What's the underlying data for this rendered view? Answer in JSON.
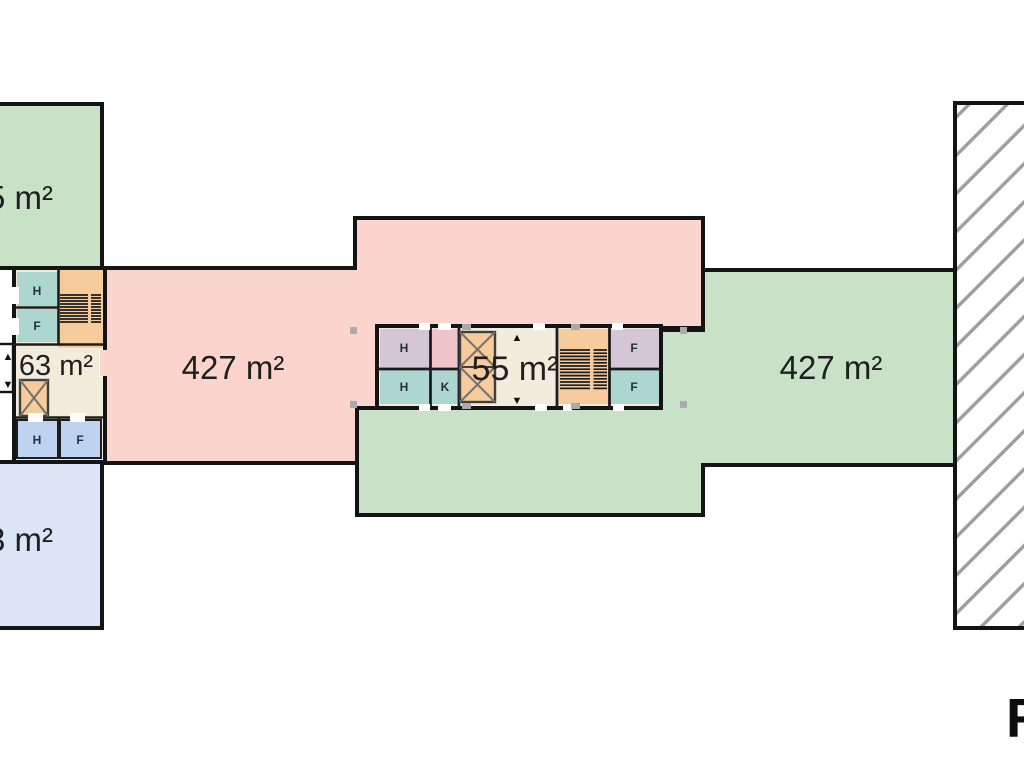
{
  "colors": {
    "wall": "#141414",
    "green_area": "#c9e2c7",
    "pink_area": "#fbd4cd",
    "blue_area": "#dbe5f6",
    "blue_room": "#bfd2ef",
    "teal_room": "#aed6d0",
    "lavender_room": "#d4c6d4",
    "peach_service": "#f6cc9c",
    "cream_corridor": "#f1ecdb",
    "pink_room": "#eec4c8",
    "hatch_line": "#a29aa0",
    "selection_handle": "#ababab",
    "label_text": "#1f1f1f"
  },
  "labels": {
    "top_left_area": "5 m²",
    "bottom_left_area": "3 m²",
    "left_core_area": "63 m²",
    "left_wing_area": "427 m²",
    "center_core_area": "55 m²",
    "right_wing_area": "427 m²",
    "watermark": "R"
  },
  "rooms": {
    "left_h_top": "H",
    "left_f": "F",
    "left_blue_h": "H",
    "left_blue_f": "F",
    "center_h_top": "H",
    "center_h_bottom": "H",
    "center_k": "K",
    "center_f_top": "F",
    "center_f_bottom": "F"
  },
  "icons": {
    "up_arrow": "▲",
    "down_arrow": "▼"
  }
}
